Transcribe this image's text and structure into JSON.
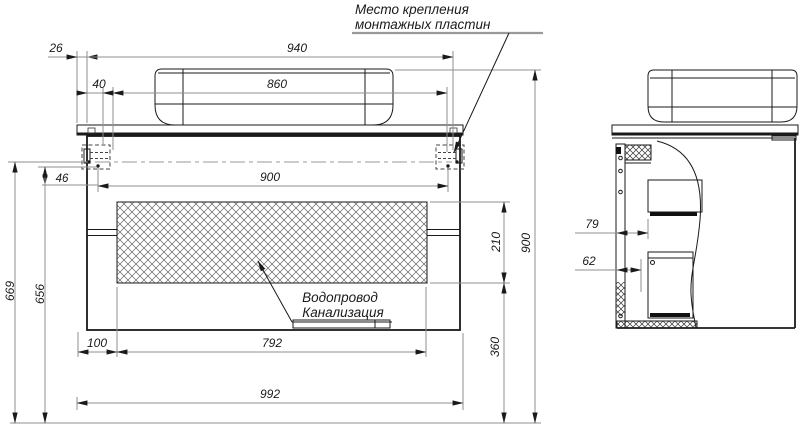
{
  "callouts": {
    "mounting": {
      "line1": "Место крепления",
      "line2": "монтажных пластин"
    },
    "plumbing": {
      "line1": "Водопровод",
      "line2": "Канализация"
    }
  },
  "dims": {
    "d26": "26",
    "d940": "940",
    "d40": "40",
    "d860": "860",
    "d900h": "900",
    "d46": "46",
    "d669": "669",
    "d656": "656",
    "d100": "100",
    "d792": "792",
    "d992": "992",
    "d210": "210",
    "d360": "360",
    "d900v": "900",
    "d79": "79",
    "d62": "62"
  },
  "colors": {
    "line": "#1a1a1a",
    "dimension": "#8f8f8f",
    "background": "#ffffff"
  }
}
